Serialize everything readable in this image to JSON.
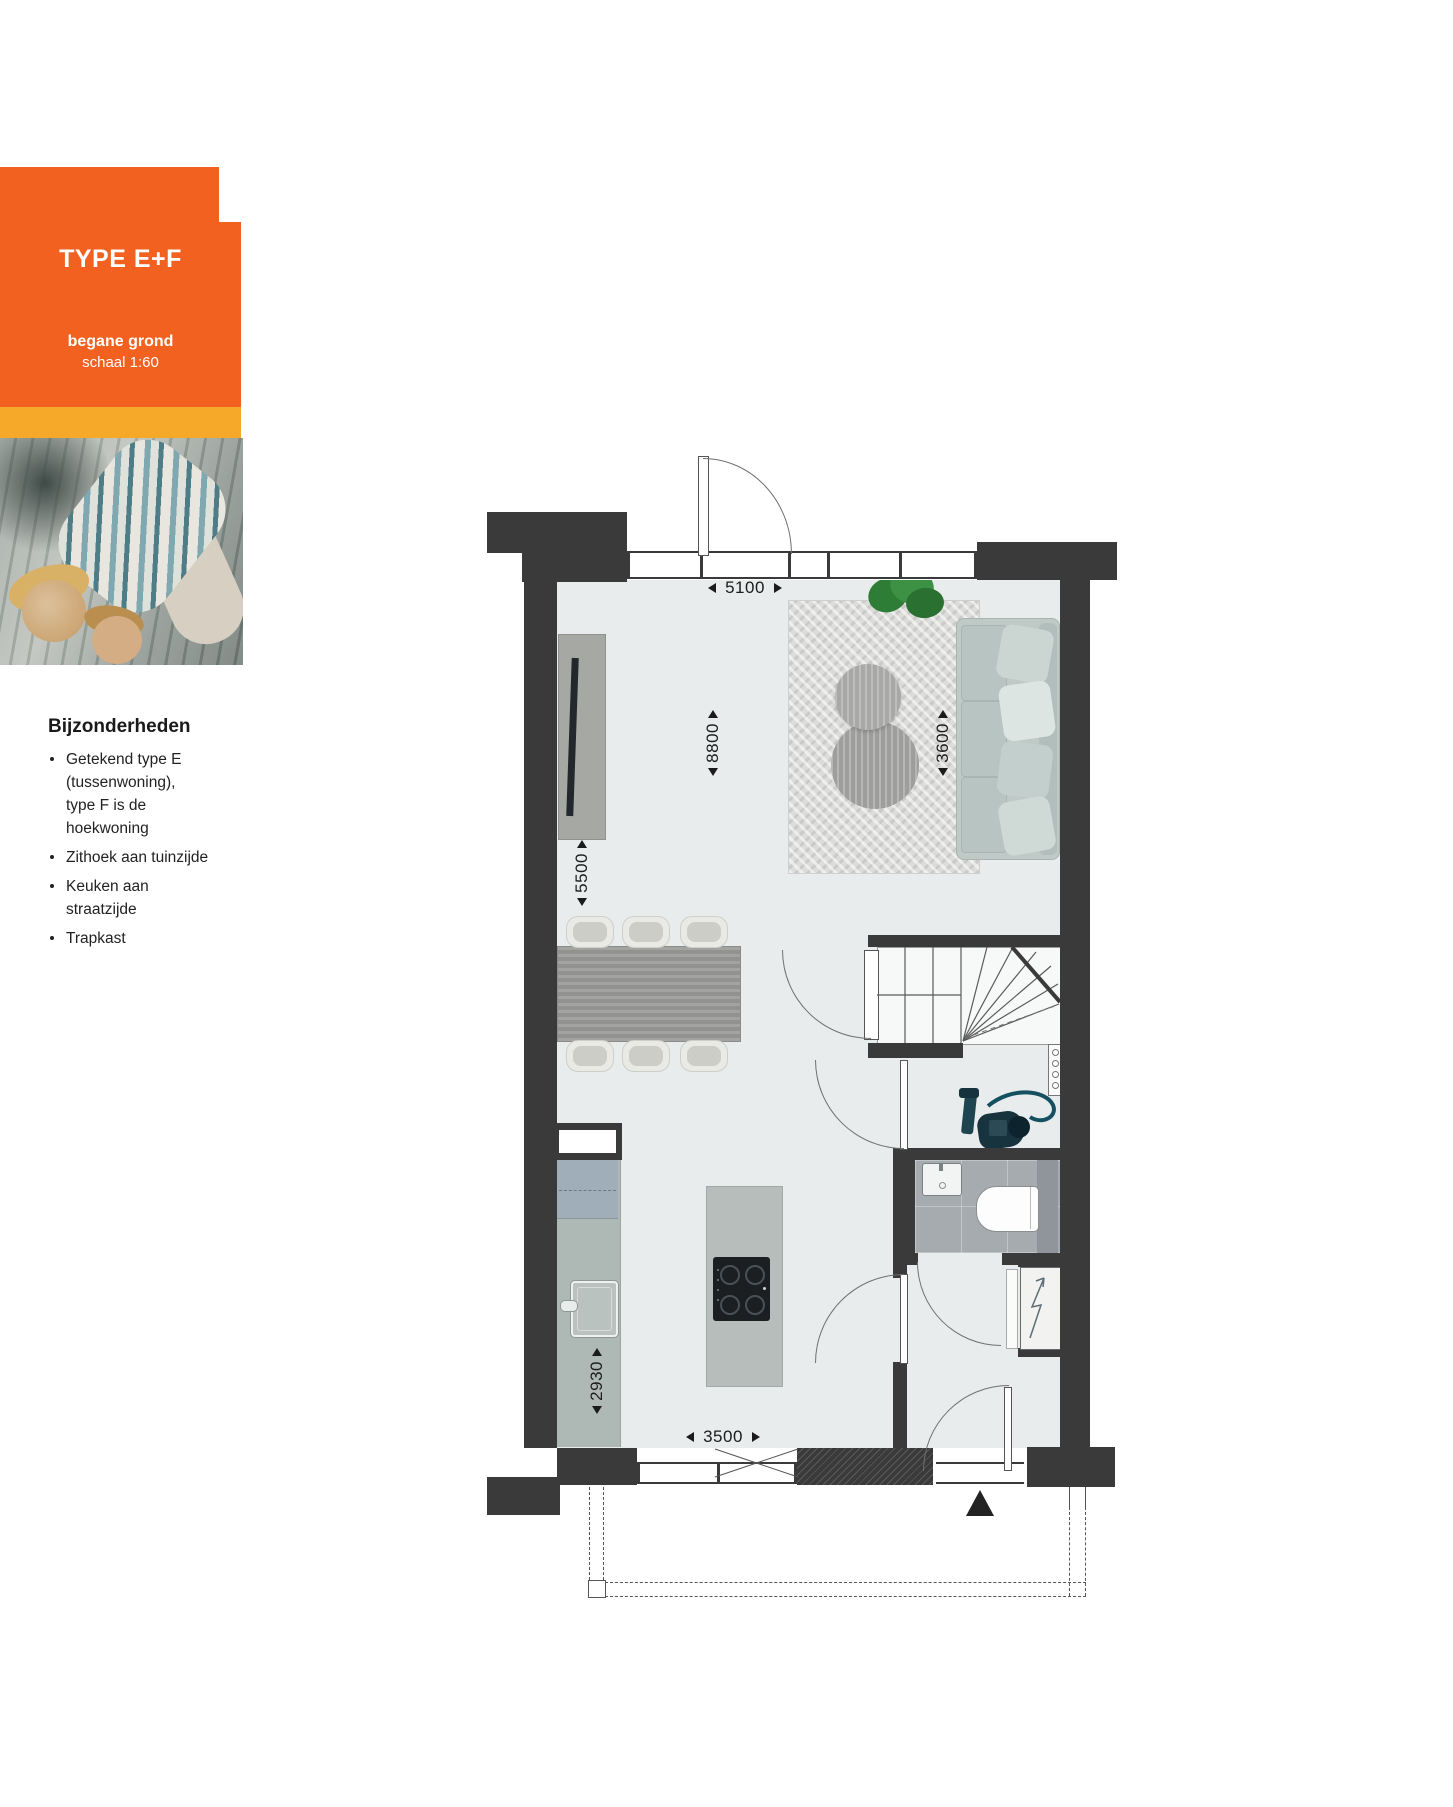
{
  "card": {
    "title": "TYPE E+F",
    "floor_label": "begane grond",
    "scale_label": "schaal 1:60"
  },
  "details": {
    "heading": "Bijzonderheden",
    "items": [
      [
        "Getekend type E",
        "(tussenwoning),",
        "type F is de",
        "hoekwoning"
      ],
      [
        "Zithoek aan tuinzijde"
      ],
      [
        "Keuken aan",
        "straatzijde"
      ],
      [
        "Trapkast"
      ]
    ]
  },
  "floorplan": {
    "dimensions": {
      "top_width": "5100",
      "living_depth": "8800",
      "sitting_width": "3600",
      "upper_left_depth": "5500",
      "kitchen_depth": "2930",
      "bottom_width": "3500"
    }
  },
  "icons": {
    "entrance-marker": "css-triangle-up",
    "electric-meter": "zigzag-arrow"
  },
  "colors": {
    "orange": "#F2611F",
    "amber": "#F6A828",
    "wall_dark": "#3A3A3A",
    "floor_light": "#E8ECED"
  }
}
